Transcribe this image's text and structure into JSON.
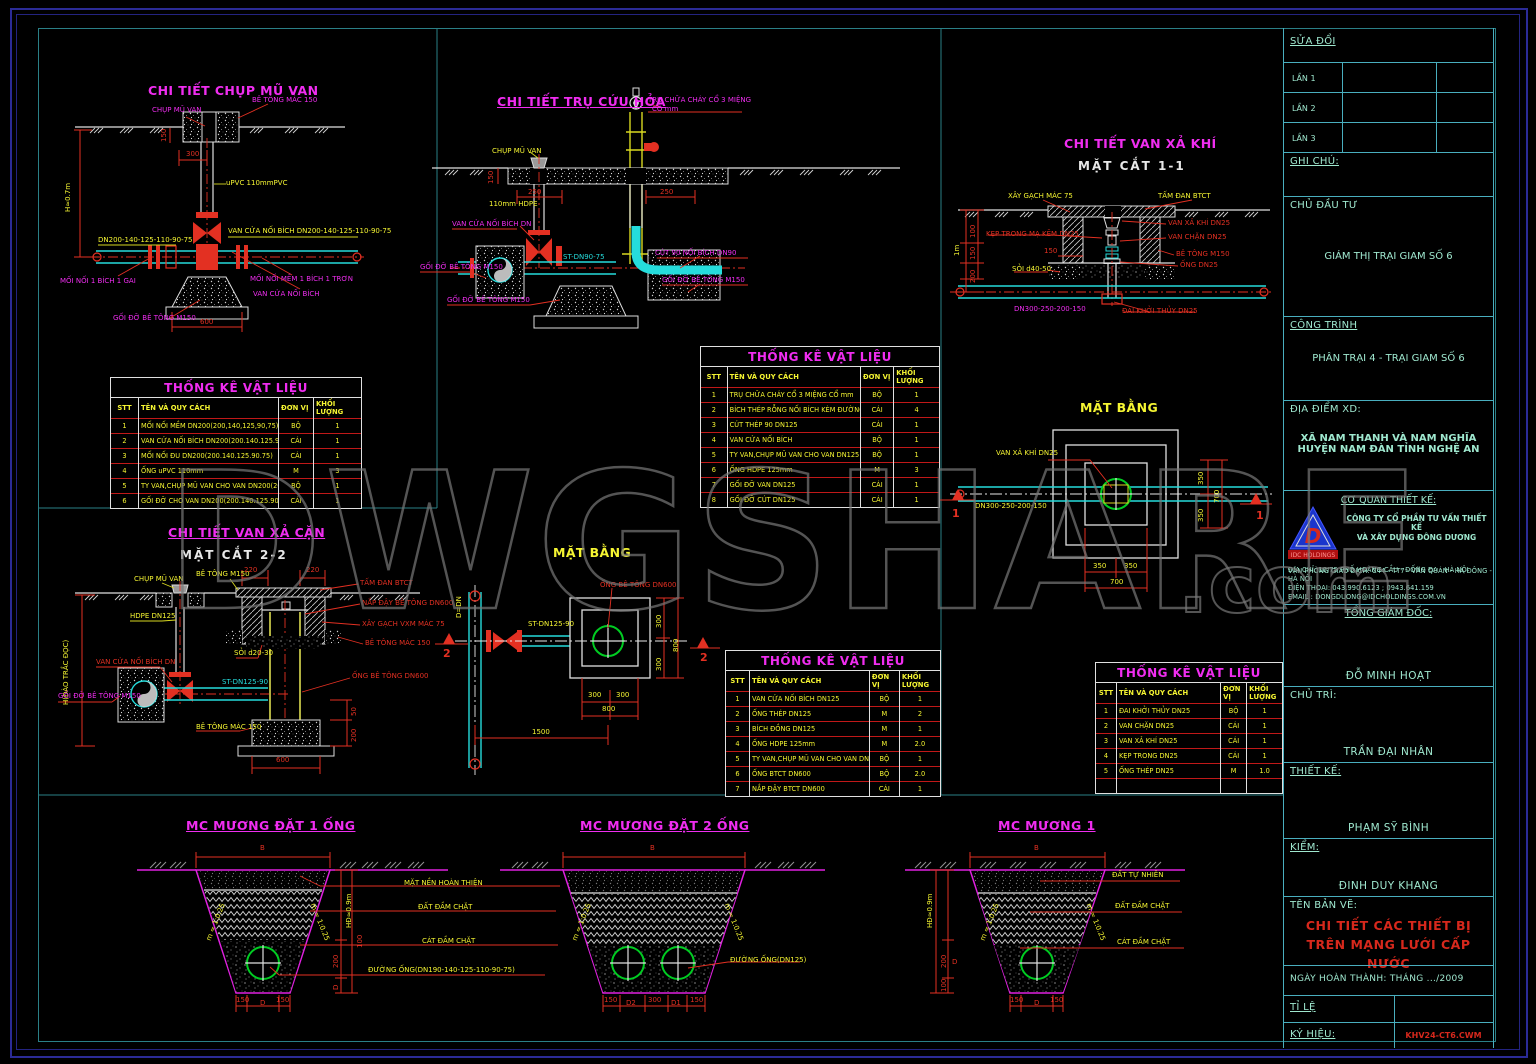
{
  "watermark": {
    "text": "DWGSHARE",
    "suffix": ".com"
  },
  "colors": {
    "magenta": "#f02df0",
    "yellow": "#f5f532",
    "red": "#e33022",
    "cyan": "#25dcdc",
    "teal_text": "#9fe8cf",
    "frame_blue": "#2b2b96",
    "frame_teal": "#2a7f86"
  },
  "tables": {
    "title": "THỐNG KÊ VẬT LIỆU",
    "headers": [
      "STT",
      "TÊN VÀ QUY CÁCH",
      "ĐƠN VỊ",
      "KHỐI LƯỢNG"
    ],
    "t1": {
      "rows": [
        [
          "1",
          "MỐI NỐI MỀM DN200(200,140,125,90,75)",
          "BỘ",
          "1"
        ],
        [
          "2",
          "VAN CỬA NỐI BÍCH DN200(200.140.125.90.75)",
          "CÁI",
          "1"
        ],
        [
          "3",
          "MỐI NỐI ĐU DN200(200.140.125.90.75)",
          "CÁI",
          "1"
        ],
        [
          "4",
          "ỐNG uPVC 110mm",
          "M",
          "3"
        ],
        [
          "5",
          "TY VAN,CHỤP MŨ VAN CHO VAN DN200(200.140.125.90.75)",
          "BỘ",
          "1"
        ],
        [
          "6",
          "GỐI ĐỠ CHO VAN DN200(200.140.125.90.75)",
          "CÁI",
          "1"
        ]
      ]
    },
    "t2": {
      "rows": [
        [
          "1",
          "TRỤ CHỮA CHÁY CỔ 3 MIỆNG CỔ mm",
          "BỘ",
          "1"
        ],
        [
          "2",
          "BÍCH THÉP RỖNG NỐI BÍCH KÈM ĐƯỜNG ỐNG",
          "CÁI",
          "4"
        ],
        [
          "3",
          "CÚT THÉP 90 DN125",
          "CÁI",
          "1"
        ],
        [
          "4",
          "VAN CỬA NỐI BÍCH",
          "BỘ",
          "1"
        ],
        [
          "5",
          "TY VAN,CHỤP MŨ VAN CHO VAN DN125",
          "BỘ",
          "1"
        ],
        [
          "6",
          "ỐNG HDPE 125mm",
          "M",
          "3"
        ],
        [
          "7",
          "GỐI ĐỠ VAN DN125",
          "CÁI",
          "1"
        ],
        [
          "8",
          "GỐI ĐỠ CÚT DN125",
          "CÁI",
          "1"
        ]
      ]
    },
    "t3": {
      "rows": [
        [
          "1",
          "VAN CỬA NỐI BÍCH DN125",
          "BỘ",
          "1"
        ],
        [
          "2",
          "ỐNG THÉP DN125",
          "M",
          "2"
        ],
        [
          "3",
          "BÍCH ĐỒNG DN125",
          "M",
          "1"
        ],
        [
          "4",
          "ỐNG HDPE 125mm",
          "M",
          "2.0"
        ],
        [
          "5",
          "TY VAN,CHỤP MŨ VAN CHO VAN DN125",
          "BỘ",
          "1"
        ],
        [
          "6",
          "ỐNG BTCT DN600",
          "BỘ",
          "2.0"
        ],
        [
          "7",
          "NẮP ĐẬY BTCT DN600",
          "CÁI",
          "1"
        ]
      ]
    },
    "t4": {
      "rows": [
        [
          "1",
          "ĐAI KHỞI THỦY DN25",
          "BỘ",
          "1"
        ],
        [
          "2",
          "VAN CHẶN DN25",
          "CÁI",
          "1"
        ],
        [
          "3",
          "VAN XẢ KHÍ DN25",
          "CÁI",
          "1"
        ],
        [
          "4",
          "KẸP TRONG DN25",
          "CÁI",
          "1"
        ],
        [
          "5",
          "ỐNG THÉP DN25",
          "M",
          "1.0"
        ],
        [
          "",
          "",
          "",
          ""
        ]
      ]
    }
  },
  "details": {
    "cap": {
      "title": "CHI TIẾT CHỤP MŨ VAN",
      "cap_label": "CHỤP MŨ VAN",
      "concrete": "BÊ TÔNG MÁC 150",
      "dim150": "150",
      "dim300": "300",
      "pipe": "uPVC 110mmPVC",
      "dim_h": "H≈0.7m",
      "dn_run": "DN200-140-125-110-90-75",
      "valve_flange": "VAN CỬA NỐI BÍCH DN200-140-125-110-90-75",
      "joint1": "MỐI NỐI 1 BÍCH 1 GAI",
      "joint2": "MỐI NỐI MỀM 1 BÍCH 1 TRƠN",
      "gate": "VAN CỬA NỐI BÍCH",
      "support": "GỐI ĐỠ BÊ TÔNG M150",
      "dim600": "600"
    },
    "hydrant": {
      "title": "CHI TIẾT TRỤ CỨU HỎA",
      "tru1": "TRỤ CHỮA CHÁY CỔ 3 MIỆNG",
      "tru2": "CỔ mm",
      "cap": "CHỤP MŨ VAN",
      "dim150": "150",
      "dim250a": "250",
      "dim250b": "250",
      "hdpe": "110mm HDPE",
      "valve": "VAN CỬA NỐI BÍCH DN",
      "st": "ST-DN90-75",
      "cut": "CÚT 90 NỐI BÍCH DN90",
      "support_left": "GỐI ĐỠ BÊ TÔNG M150",
      "support_right": "GỐI ĐỠ BÊ TÔNG M150",
      "support_bottom": "GỐI ĐỠ BÊ TÔNG M150"
    },
    "airvalve": {
      "title": "CHI TIẾT VAN XẢ KHÍ",
      "section": "MẶT CẮT 1-1",
      "brick": "XÂY GẠCH MÁC 75",
      "slab": "TẤM ĐAN BTCT",
      "valve": "VAN XẢ KHÍ DN25",
      "clamp": "KẸP TRONG MẠ KẼM DN25",
      "stop": "VAN CHẶN DN25",
      "concrete": "BÊ TÔNG M150",
      "dim150": "150",
      "gravel": "SỎI d40-50",
      "pipe": "ỐNG DN25",
      "dn": "DN300-250-200-150",
      "saddle": "ĐAI KHỞI THỦY DN25",
      "dim_1m": "1m",
      "dim100": "100",
      "dim150b": "150",
      "dim200": "200"
    },
    "plan_air": {
      "title": "MẶT BẰNG",
      "valve": "VAN XẢ KHÍ DN25",
      "dn": "DN300-250-200-150",
      "dim350a": "350",
      "dim350b": "350",
      "dim700": "700",
      "dim350c": "350",
      "dim350d": "350",
      "dim700b": "700",
      "marker": "1"
    },
    "washout": {
      "title": "CHI TIẾT VAN XẢ CẶN",
      "section": "MẶT CẮT 2-2",
      "cap": "CHỤP MŨ VAN",
      "concrete": "BÊ TÔNG M150",
      "dim220a": "220",
      "dim220b": "220",
      "slab": "TẤM ĐAN BTCT",
      "lid": "NẮP ĐẬY BÊ TÔNG DN600",
      "brick": "XÂY GẠCH VXM MÁC 75",
      "concrete150": "BÊ TÔNG MÁC 150",
      "hdpe": "HDPE DN125",
      "dim_h": "H(ĐÀO TRẮC ĐỌC)",
      "valve": "VAN CỬA NỐI BÍCH DN",
      "gravel": "SỎI d20-30",
      "st": "ST-DN125-90",
      "tube": "ỐNG BÊ TÔNG DN600",
      "support": "GỐI ĐỠ BÊ TÔNG M150",
      "concrete_b": "BÊ TÔNG MÁC 150",
      "dim600": "600",
      "dim200": "200",
      "dim50": "50"
    },
    "plan_washout": {
      "title": "MẶT BẰNG",
      "tube": "ỐNG BÊ TÔNG DN600",
      "d_dn": "D=DN",
      "st": "ST-DN125-90",
      "dim300a": "300",
      "dim300b": "300",
      "dim800": "800",
      "marker": "2",
      "dim300c": "300",
      "dim300d": "300",
      "dim800b": "800",
      "dim1500": "1500"
    }
  },
  "trenches": {
    "shared": {
      "surface": "MẶT NỀN HOÀN THIỆN",
      "soil": "ĐẤT ĐẦM CHẶT",
      "sand": "CÁT ĐẦM CHẶT",
      "pipe_run": "ĐƯỜNG ỐNG(DN190-140-125-110-90-75)"
    },
    "t1": {
      "title": "MC MƯƠNG ĐẶT 1 ỐNG",
      "dim_b": "B",
      "slope": "m = 1:0.25",
      "dim_h": "HĐ≈0.9m",
      "dim200": "200",
      "dim_d": "D",
      "dim100": "100",
      "dim150l": "150",
      "dim_dd": "D",
      "dim150r": "150"
    },
    "t2": {
      "title": "MC MƯƠNG ĐẶT 2 ỐNG",
      "dim_b": "B",
      "slope": "m = 1:0.25",
      "pipe": "ĐƯỜNG ỐNG(DN125)",
      "dim150l": "150",
      "dim_d2": "D2",
      "dim300": "300",
      "dim_d1": "D1",
      "dim150r": "150"
    },
    "t3": {
      "title": "MC MƯƠNG 1",
      "dim_b": "B",
      "slope": "m = 1:0.25",
      "natural": "ĐẤT TỰ NHIÊN",
      "soil": "ĐẤT ĐẦM CHẶT",
      "sand": "CÁT ĐẦM CHẶT",
      "dim_h": "HĐ≈0.9m",
      "dim200": "200",
      "dim_d": "D",
      "dim100": "100",
      "dim150l": "150",
      "dim_dd": "D",
      "dim150r": "150"
    }
  },
  "titleblock": {
    "sua_doi": "SỬA ĐỔI",
    "lan1": "LẦN 1",
    "lan2": "LẦN 2",
    "lan3": "LẦN 3",
    "ghi_chu": "GHI CHÚ:",
    "chu_dau_tu": "CHỦ ĐẦU TƯ",
    "chu_dau_tu_value": "GIÁM THỊ TRẠI GIAM SỐ 6",
    "cong_trinh": "CÔNG TRÌNH",
    "cong_trinh_value": "PHÂN TRẠI 4 - TRẠI GIAM SỐ 6",
    "dia_diem": "ĐỊA ĐIỂM XD:",
    "dia_diem_1": "XÃ NAM THANH VÀ NAM NGHĨA",
    "dia_diem_2": "HUYỆN NAM ĐÀN TỈNH NGHỆ AN",
    "co_quan": "CƠ QUAN THIẾT KẾ:",
    "cong_ty_1": "CÔNG TY CỔ PHẦN TƯ VẤN THIẾT KẾ",
    "cong_ty_2": "VÀ XÂY DỰNG ĐÔNG DƯƠNG",
    "dia_chi": "ĐỊA CHỈ: 10/75 PHỐ HOÀNG CẦU - ĐỐNG ĐA - HÀ NỘI",
    "van_phong": "VĂN PHÒNG GIAO DỊCH: C44 - TT7 - VĂN QUÁN - HÀ ĐÔNG - HÀ NỘI",
    "dien_thoai": "ĐIỆN THOẠI: 043.990.6123 ; 0943.641.159",
    "email": "EMAIL : DONGDUONG@IDCHOLDINGS.COM.VN",
    "logo_banner": "IDC HOLDINGS",
    "tong_giam_doc": "TỔNG GIÁM ĐỐC:",
    "tong_giam_doc_name": "ĐỖ MINH HOẠT",
    "chu_tri": "CHỦ TRÌ:",
    "chu_tri_name": "TRẦN ĐẠI NHÂN",
    "thiet_ke": "THIẾT KẾ:",
    "thiet_ke_name": "PHẠM SỸ BÌNH",
    "kiem": "KIỂM:",
    "kiem_name": "ĐINH DUY KHANG",
    "ten_ban_ve": "TÊN BẢN VẼ:",
    "ten_ban_ve_1": "CHI TIẾT CÁC THIẾT BỊ",
    "ten_ban_ve_2": "TRÊN MẠNG LƯỚI CẤP NƯỚC",
    "ngay": "NGÀY HOÀN THÀNH: THÁNG .../2009",
    "ti_le": "TỈ LỆ",
    "ky_hieu": "KÝ HIỆU:",
    "ky_hieu_code": "KHV24-CT6.CWM"
  }
}
